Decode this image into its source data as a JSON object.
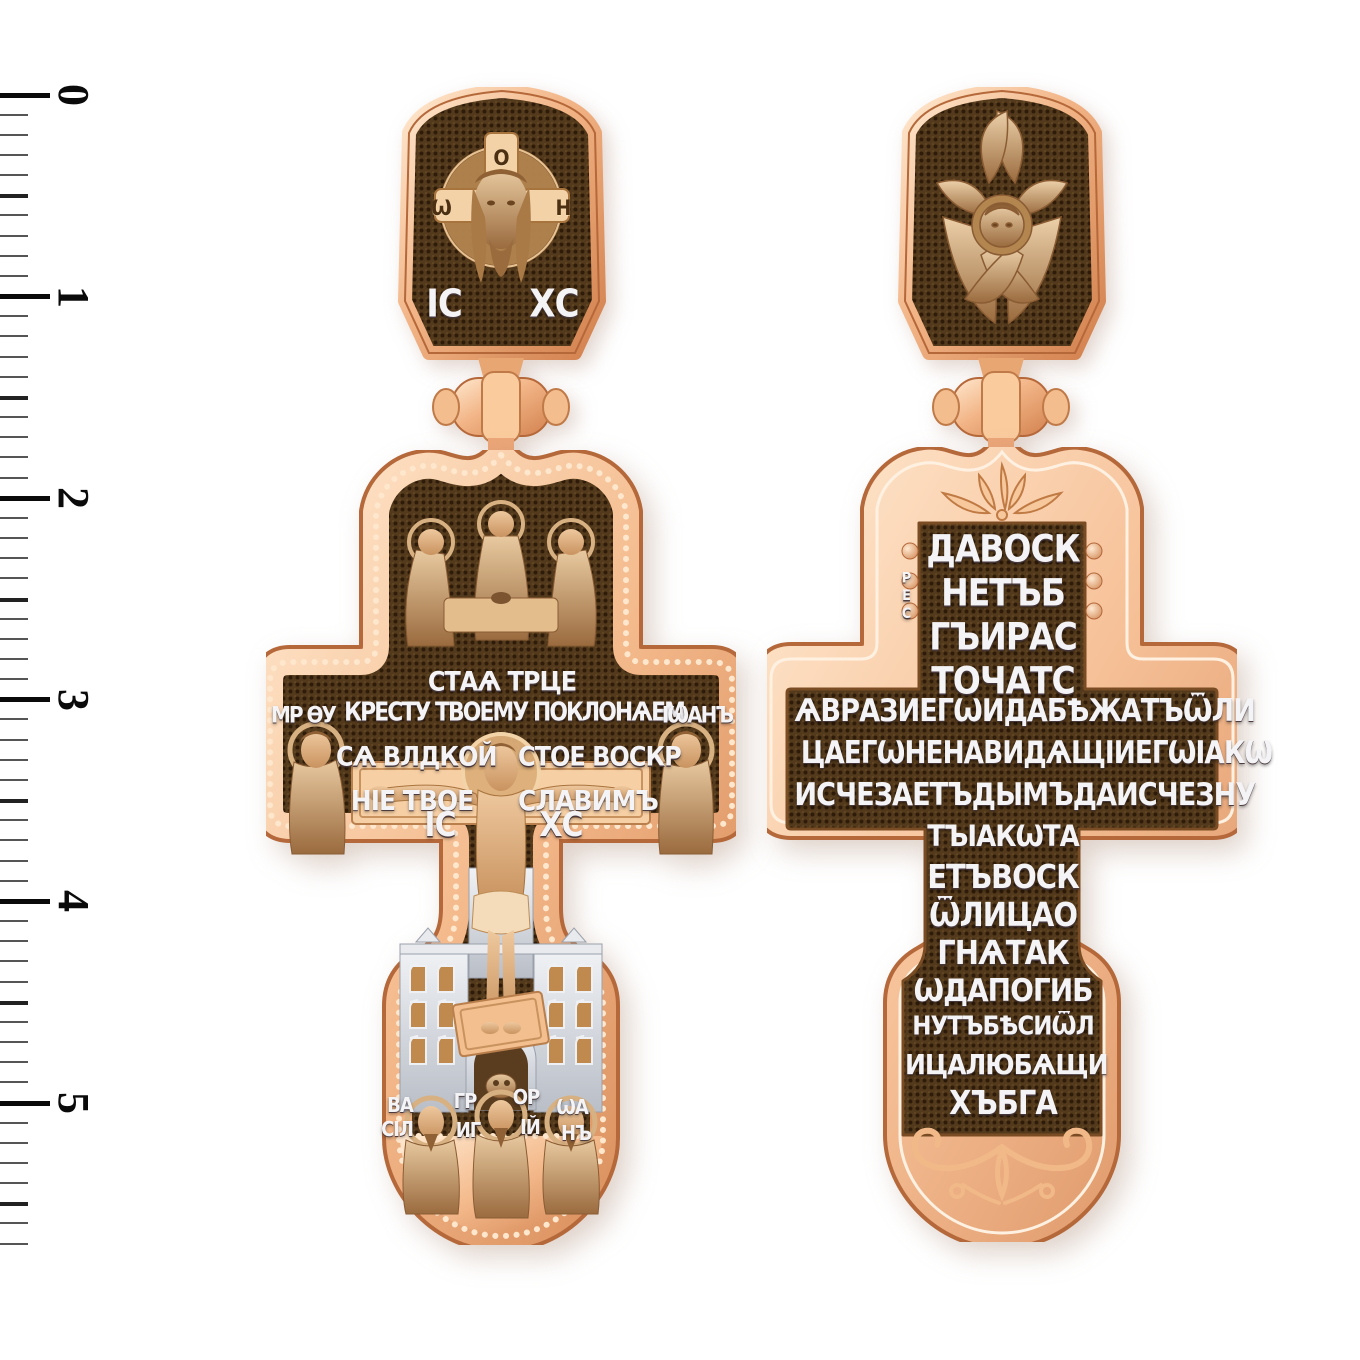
{
  "ruler": {
    "labels": [
      "0",
      "1",
      "2",
      "3",
      "4",
      "5"
    ]
  },
  "front_cross": {
    "bail": {
      "halo_left": "Ѡ",
      "halo_top": "О",
      "halo_right": "Н",
      "ic": "ІС",
      "xc": "ХС"
    },
    "title": "СТАѦ ТРЦЕ",
    "mary_monogram": "МР ѲУ",
    "john_label": "ІѠАНЪ",
    "prayer_line1": "КРЕСТУ ТВОЕМУ ПОКЛОНѦЕМ",
    "prayer_line2_left": "СѦ ВЛДКОЙ",
    "prayer_line2_right": "СТОЕ ВОСКР",
    "prayer_line3_left": "НІЕ ТВОЕ",
    "prayer_line3_right": "СЛАВИМЪ",
    "ic": "ІС",
    "xc": "ХС",
    "saint_labels": [
      "ВА",
      "СІЛ",
      "ГР",
      "ИГ",
      "ОР",
      "ІЙ",
      "ѠА",
      "НЪ"
    ]
  },
  "back_cross": {
    "res_vertical": "РЕС",
    "lines": [
      "ДАВОСК",
      "НЕТЪБ",
      "ГЪИРАС",
      "ТОЧАТС",
      "ѦВРАЗИЕГѠИДАБѢЖАТЪѾЛИ",
      "ЦАЕГѠНЕНАВИДѦЩІИЕГѠІАКѠ",
      "ИСЧЕЗАЕТЪДЫМЪДАИСЧЕЗНУ",
      "ТЪІАКѠТА",
      "ЕТЪВОСК",
      "ѾЛИЦАО",
      "ГНѦТАК",
      "ѠДАПОГИБ",
      "НУТЪБѢСИѾЛ",
      "ИЦАЛЮБѦЩИ",
      "ХЪБГА"
    ]
  },
  "colors": {
    "gold_light": "#ffe3c4",
    "gold": "#eba678",
    "gold_deep": "#c97c48",
    "panel_brown": "#54381a",
    "letters": "#f4f3f6",
    "silver": "#dde0e6",
    "bronze": "#c59468",
    "skin": "#dfb187"
  }
}
